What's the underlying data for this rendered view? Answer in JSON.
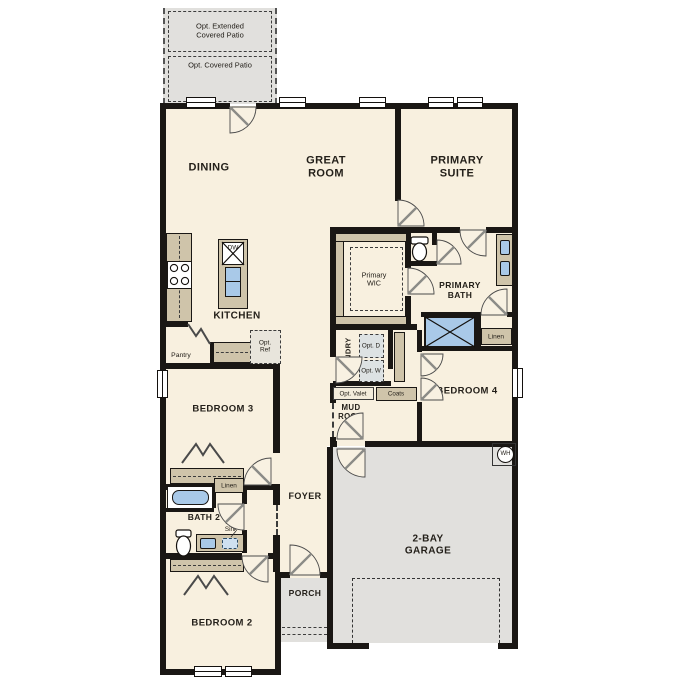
{
  "colors": {
    "floor": "#f8f0df",
    "wall": "#1a1714",
    "cabinet_tan": "#cfc4aa",
    "fixture_blue": "#a9c9e8",
    "patio_gray": "#e1e0dd",
    "garage_gray": "#e1e0dd"
  },
  "patio": {
    "extended_label": "Opt. Extended Covered Patio",
    "covered_label": "Opt. Covered Patio"
  },
  "rooms": {
    "dining": "DINING",
    "great_room": "GREAT ROOM",
    "primary_suite": "PRIMARY SUITE",
    "kitchen": "KITCHEN",
    "primary_wic": "Primary WIC",
    "primary_bath": "PRIMARY BATH",
    "laundry": "LAUNDRY",
    "mud_room": "MUD ROOM",
    "bedroom4": "BEDROOM 4",
    "bedroom3": "BEDROOM 3",
    "bath2": "BATH 2",
    "foyer": "FOYER",
    "bedroom2": "BEDROOM 2",
    "porch": "PORCH",
    "garage": "2-BAY GARAGE"
  },
  "features": {
    "dishwasher": "DW",
    "pantry": "Pantry",
    "opt_ref": "Opt. Ref",
    "opt_dryer": "Opt. D",
    "opt_washer": "Opt. W",
    "opt_valet": "Opt. Valet",
    "coats": "Coats",
    "linen_bath": "Linen",
    "linen_hall": "Linen",
    "linen_bed3": "Linen",
    "opt_sink": "Opt. Sink",
    "water_heater": "WH"
  }
}
